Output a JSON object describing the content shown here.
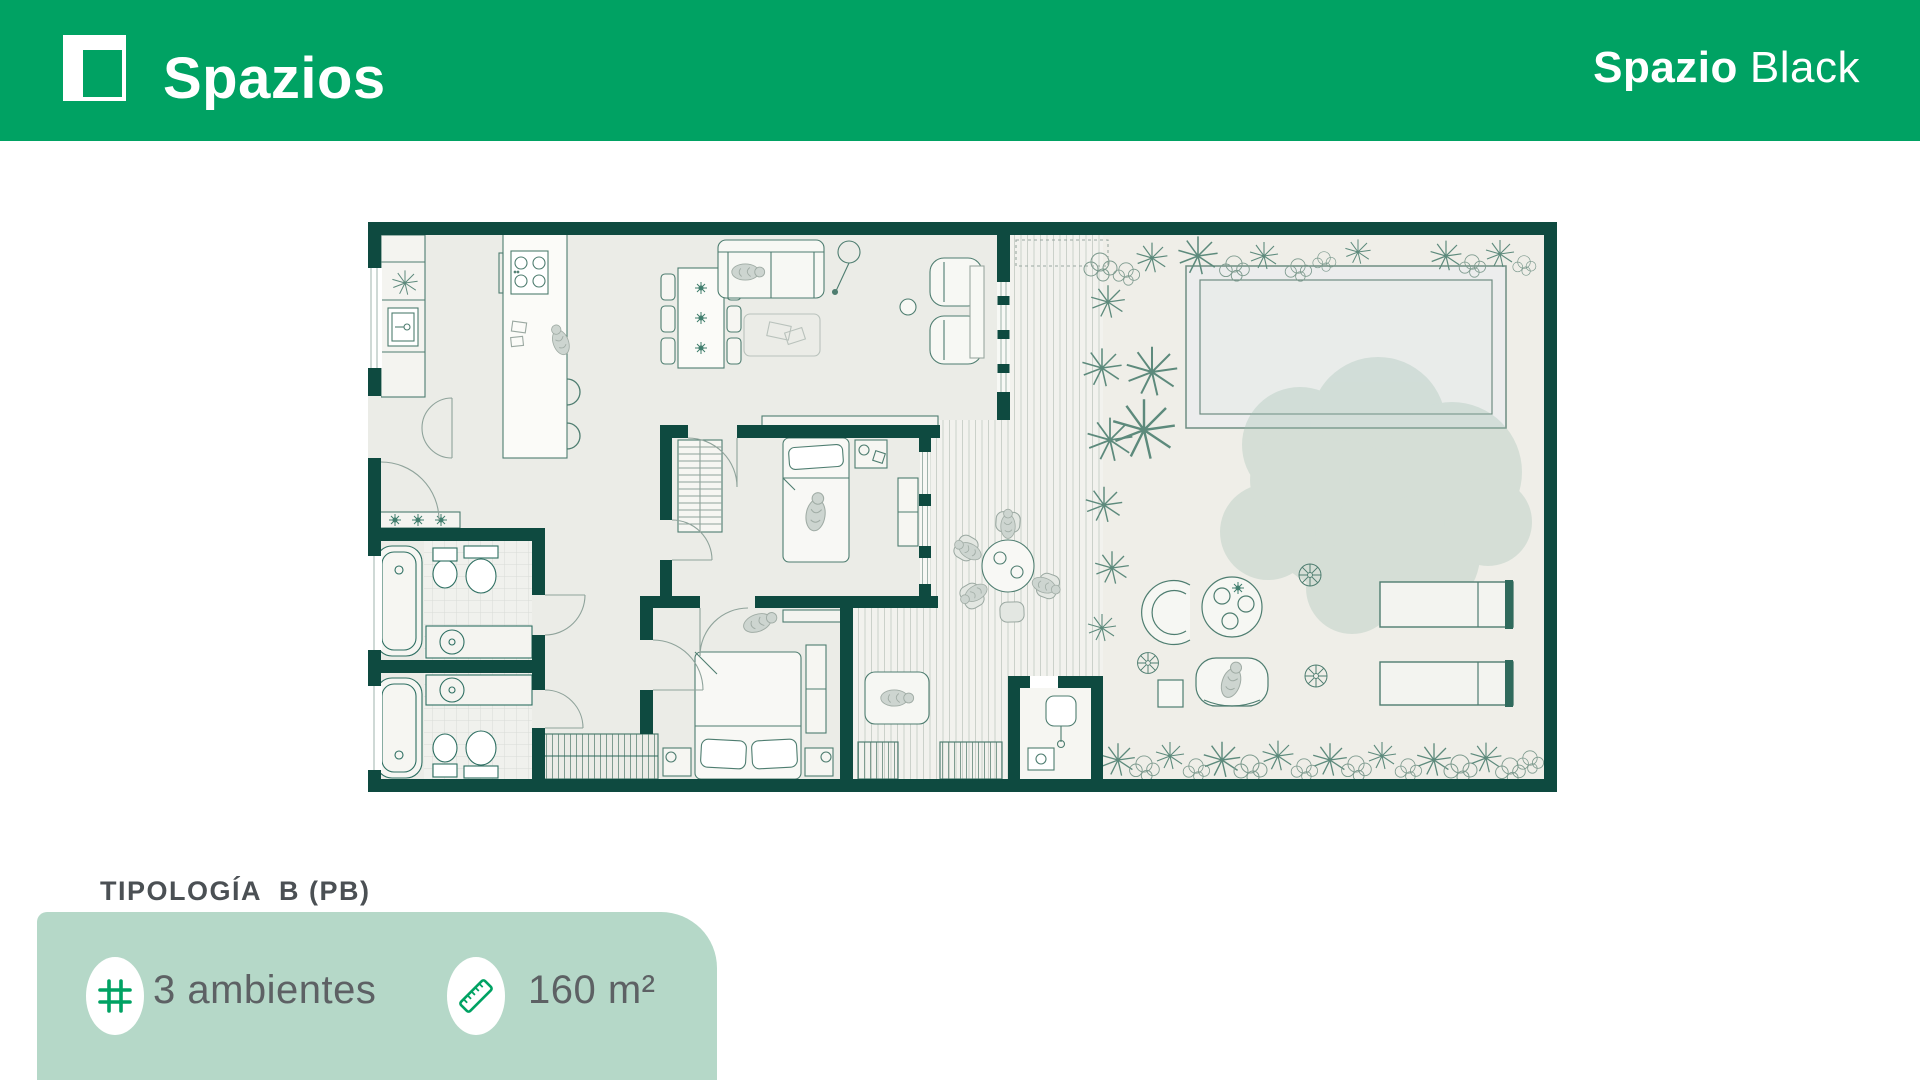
{
  "header": {
    "brand": "Spazios",
    "product_bold": "Spazio",
    "product_light": "Black"
  },
  "typology": {
    "label": "TIPOLOGÍA  B (PB)"
  },
  "features": {
    "rooms": {
      "icon": "grid-icon",
      "label": "3 ambientes"
    },
    "area": {
      "icon": "ruler-icon",
      "label": "160 m²"
    }
  },
  "colors": {
    "brand_green": "#00a263",
    "wall_green": "#0e4a40",
    "card_green": "#b5d8c8",
    "floor": "#ebece7",
    "garden": "#efeee8",
    "deck": "#f2f2ee",
    "text_gray": "#5d6164"
  }
}
